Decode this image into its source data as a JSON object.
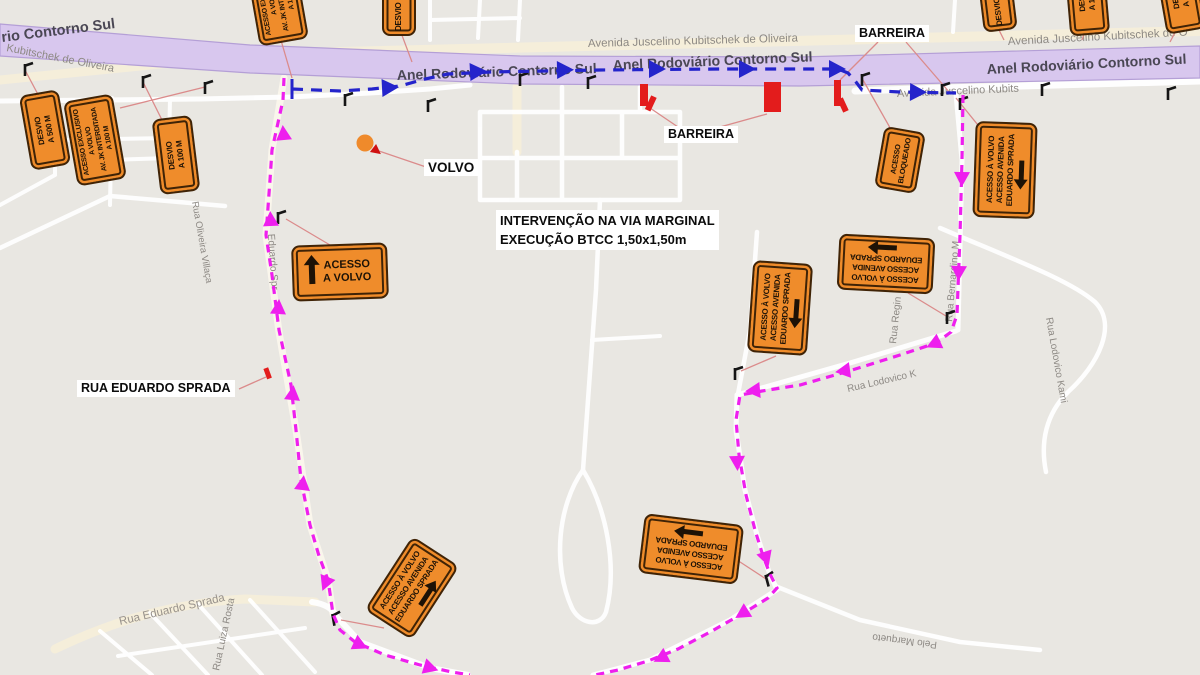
{
  "labels": {
    "barreira": "BARREIRA",
    "volvo": "VOLVO",
    "rua_eduardo_sprada": "RUA EDUARDO SPRADA",
    "intervention_line1": "INTERVENÇÃO NA VIA MARGINAL",
    "intervention_line2": "EXECUÇÃO  BTCC 1,50x1,50m"
  },
  "highway": {
    "ring_road": "Anel Rodoviário Contorno Sul",
    "ring_road_partial": "rio Contorno Sul",
    "avenue_full": "Avenida Juscelino Kubitschek de Oliveira",
    "avenue_right": "Avenida Juscelino Kubitschek de O",
    "avenue_below_right": "Avenida Juscelino Kubits",
    "avenue_left_partial": "Kubitschek de Oliveira"
  },
  "streets": {
    "eduardo_sprada_diag": "Eduardo Spr",
    "rua_eduardo_sprada_road": "Rua Eduardo Sprada",
    "rua_oliveira_villaca": "Rua Oliveira Villaça",
    "rua_luiza_rosta": "Rua Luiza Rosta",
    "rua_regina": "Rua Regin",
    "rua_lodovico": "Rua Lodovico K",
    "rua_lodovico_kami": "Rua Lodovico Kami",
    "rua_bernardino": "Rua Bernardino M",
    "pelo_marqueto": "Pelo Marqueto"
  },
  "signs": {
    "desvio_500": {
      "line1": "DESVIO",
      "line2": "A 500 M"
    },
    "desvio_100": {
      "line1": "DESVIO",
      "line2": "A 100 M"
    },
    "desvio": {
      "line1": "DESVIO",
      "arrow": "right"
    },
    "acesso_exclusivo": {
      "line1": "ACESSO EXCLUSIVO",
      "line2": "A VOLVO",
      "line3": "AV. JK INTERDITADA",
      "line4": "A 100 M"
    },
    "acesso_bloqueado": {
      "line1": "ACESSO",
      "line2": "BLOQUEADO"
    },
    "acesso_a_volvo": {
      "line1": "ACESSO",
      "line2": "A VOLVO",
      "arrow": "up"
    },
    "acesso_avenida": {
      "line1": "ACESSO À VOLVO",
      "line2": "ACESSO AVENIDA",
      "line3": "EDUARDO SPRADA"
    }
  },
  "colors": {
    "detour_magenta": "#ee1fee",
    "route_blue": "#2424cb",
    "sign_orange": "#ef8c2b",
    "barrier_red": "#e31c1c",
    "highway_band": "#d8c7ee"
  }
}
